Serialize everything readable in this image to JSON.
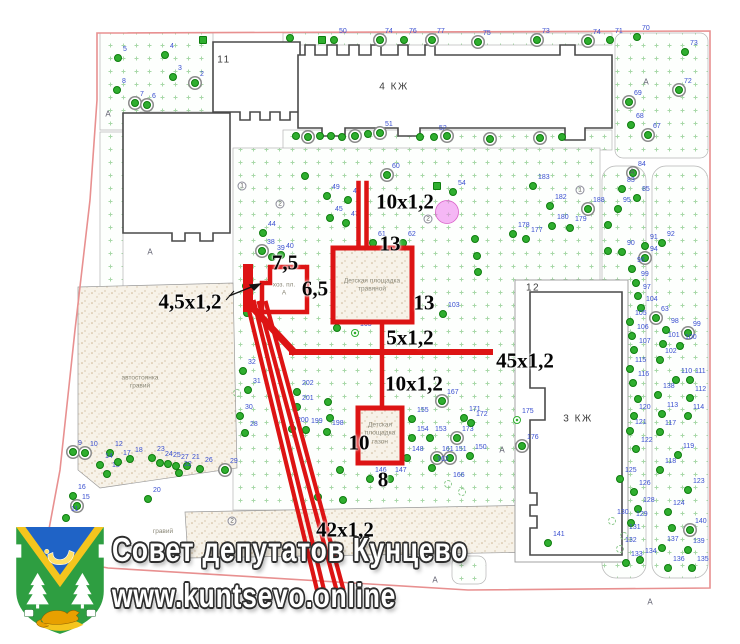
{
  "watermark": {
    "line1": "Совет депутатов Кунцево",
    "line2": "www.kuntsevo.online"
  },
  "map": {
    "building_labels": [
      {
        "text": "11",
        "x": 224,
        "y": 60
      },
      {
        "text": "4 КЖ",
        "x": 394,
        "y": 87
      },
      {
        "text": "12",
        "x": 533,
        "y": 288
      },
      {
        "text": "3 КЖ",
        "x": 578,
        "y": 419
      }
    ],
    "dimension_labels": [
      {
        "text": "10x1,2",
        "x": 405,
        "y": 202
      },
      {
        "text": "13",
        "x": 390,
        "y": 244
      },
      {
        "text": "7,5",
        "x": 285,
        "y": 263
      },
      {
        "text": "6,5",
        "x": 315,
        "y": 289
      },
      {
        "text": "4,5x1,2",
        "x": 190,
        "y": 302
      },
      {
        "text": "13",
        "x": 424,
        "y": 303
      },
      {
        "text": "5x1,2",
        "x": 410,
        "y": 338
      },
      {
        "text": "45x1,2",
        "x": 525,
        "y": 361
      },
      {
        "text": "10x1,2",
        "x": 414,
        "y": 384
      },
      {
        "text": "10",
        "x": 359,
        "y": 443
      },
      {
        "text": "8",
        "x": 383,
        "y": 480
      },
      {
        "text": "42x1,2",
        "x": 345,
        "y": 530
      }
    ],
    "area_labels": [
      {
        "lines": [
          "автостоянка",
          "гравий"
        ],
        "x": 140,
        "y": 383
      },
      {
        "lines": [
          "гравий"
        ],
        "x": 163,
        "y": 532
      },
      {
        "lines": [
          "хоз. пл.",
          "А"
        ],
        "x": 284,
        "y": 290
      },
      {
        "lines": [
          "Детская площадка",
          "травяной"
        ],
        "x": 372,
        "y": 286
      },
      {
        "lines": [
          "Детская",
          "площадка",
          "газон"
        ],
        "x": 380,
        "y": 434
      }
    ],
    "path_letter_char": "А",
    "path_letters": [
      [
        108,
        114
      ],
      [
        150,
        252
      ],
      [
        646,
        82
      ],
      [
        632,
        172
      ],
      [
        502,
        450
      ],
      [
        650,
        602
      ],
      [
        435,
        580
      ]
    ],
    "circled_marks": [
      [
        242,
        186,
        "1"
      ],
      [
        280,
        204,
        "2"
      ],
      [
        428,
        219,
        "2"
      ],
      [
        580,
        190,
        "1"
      ],
      [
        232,
        521,
        "2"
      ]
    ],
    "trees": [
      [
        118,
        58,
        "5"
      ],
      [
        165,
        55,
        "4"
      ],
      [
        173,
        77,
        "3"
      ],
      [
        195,
        83,
        "2",
        "r"
      ],
      [
        117,
        90,
        "8"
      ],
      [
        135,
        103,
        "7",
        "r"
      ],
      [
        147,
        105,
        "6",
        "r"
      ],
      [
        203,
        40,
        "",
        "s"
      ],
      [
        290,
        38,
        ""
      ],
      [
        322,
        40,
        "",
        "s"
      ],
      [
        334,
        40,
        "50"
      ],
      [
        380,
        40,
        "74",
        "r"
      ],
      [
        404,
        40,
        "76"
      ],
      [
        432,
        40,
        "77",
        "r"
      ],
      [
        478,
        42,
        "75",
        "r"
      ],
      [
        537,
        40,
        "73",
        "r"
      ],
      [
        588,
        41,
        "74",
        "r"
      ],
      [
        610,
        40,
        "71"
      ],
      [
        637,
        37,
        "70"
      ],
      [
        685,
        52,
        "73"
      ],
      [
        679,
        90,
        "72",
        "r"
      ],
      [
        629,
        102,
        "69",
        "r"
      ],
      [
        631,
        125,
        "68"
      ],
      [
        648,
        135,
        "67",
        "r"
      ],
      [
        296,
        136,
        ""
      ],
      [
        308,
        137,
        "",
        "r"
      ],
      [
        320,
        136,
        ""
      ],
      [
        331,
        136,
        ""
      ],
      [
        342,
        137,
        ""
      ],
      [
        355,
        136,
        "",
        "r"
      ],
      [
        368,
        134,
        ""
      ],
      [
        380,
        133,
        "51",
        "r"
      ],
      [
        420,
        137,
        ""
      ],
      [
        434,
        137,
        "52"
      ],
      [
        447,
        136,
        "",
        "r"
      ],
      [
        490,
        139,
        "",
        "r"
      ],
      [
        540,
        138,
        "",
        "r"
      ],
      [
        562,
        137,
        ""
      ],
      [
        305,
        176,
        ""
      ],
      [
        387,
        175,
        "60",
        "r"
      ],
      [
        437,
        186,
        "",
        "s"
      ],
      [
        453,
        192,
        "54"
      ],
      [
        327,
        196,
        "49"
      ],
      [
        348,
        200,
        "48"
      ],
      [
        330,
        218,
        "45"
      ],
      [
        346,
        223,
        "47"
      ],
      [
        263,
        233,
        "44"
      ],
      [
        262,
        251,
        "38",
        "r"
      ],
      [
        272,
        257,
        "39"
      ],
      [
        281,
        255,
        "40"
      ],
      [
        345,
        267,
        "42",
        "f"
      ],
      [
        373,
        243,
        "61"
      ],
      [
        403,
        243,
        "62"
      ],
      [
        246,
        286,
        ""
      ],
      [
        247,
        313,
        ""
      ],
      [
        475,
        239,
        ""
      ],
      [
        477,
        256,
        ""
      ],
      [
        478,
        272,
        ""
      ],
      [
        443,
        314,
        "103"
      ],
      [
        533,
        186,
        "183"
      ],
      [
        550,
        206,
        "182"
      ],
      [
        552,
        226,
        "180"
      ],
      [
        570,
        228,
        "179"
      ],
      [
        513,
        234,
        "178"
      ],
      [
        526,
        239,
        "177"
      ],
      [
        355,
        333,
        "165",
        "f"
      ],
      [
        337,
        328,
        ""
      ],
      [
        297,
        392,
        "202"
      ],
      [
        297,
        407,
        "201"
      ],
      [
        292,
        429,
        "200"
      ],
      [
        306,
        430,
        "199"
      ],
      [
        328,
        402,
        ""
      ],
      [
        330,
        418,
        ""
      ],
      [
        327,
        432,
        "198"
      ],
      [
        412,
        419,
        "155"
      ],
      [
        412,
        438,
        "154"
      ],
      [
        407,
        458,
        "148"
      ],
      [
        390,
        479,
        "147"
      ],
      [
        370,
        479,
        "146"
      ],
      [
        430,
        438,
        "153"
      ],
      [
        457,
        438,
        "173",
        "r"
      ],
      [
        442,
        401,
        "167",
        "r"
      ],
      [
        464,
        418,
        "171"
      ],
      [
        471,
        423,
        "172"
      ],
      [
        437,
        458,
        "161",
        "r"
      ],
      [
        450,
        458,
        "151",
        "r"
      ],
      [
        470,
        456,
        "150"
      ],
      [
        432,
        468,
        "162"
      ],
      [
        448,
        484,
        "166",
        "h"
      ],
      [
        462,
        492,
        "",
        "h"
      ],
      [
        340,
        470,
        ""
      ],
      [
        318,
        497,
        ""
      ],
      [
        343,
        500,
        ""
      ],
      [
        243,
        371,
        "32"
      ],
      [
        248,
        390,
        "31"
      ],
      [
        240,
        416,
        "30"
      ],
      [
        245,
        433,
        "28"
      ],
      [
        237,
        393,
        "",
        "h"
      ],
      [
        73,
        452,
        "9",
        "r"
      ],
      [
        85,
        453,
        "10",
        "r"
      ],
      [
        110,
        453,
        "12"
      ],
      [
        100,
        465,
        "14"
      ],
      [
        107,
        474,
        "13"
      ],
      [
        118,
        462,
        "17"
      ],
      [
        130,
        459,
        "18"
      ],
      [
        152,
        458,
        "23"
      ],
      [
        160,
        463,
        "24"
      ],
      [
        168,
        464,
        "25"
      ],
      [
        176,
        466,
        "27"
      ],
      [
        187,
        466,
        "21"
      ],
      [
        179,
        473,
        "22"
      ],
      [
        200,
        469,
        "26"
      ],
      [
        225,
        470,
        "29",
        "r"
      ],
      [
        148,
        499,
        "20"
      ],
      [
        73,
        496,
        "16"
      ],
      [
        77,
        506,
        "15",
        "r"
      ],
      [
        66,
        518,
        "11"
      ],
      [
        548,
        543,
        "141"
      ],
      [
        633,
        173,
        "84",
        "r"
      ],
      [
        622,
        189,
        "83"
      ],
      [
        637,
        198,
        "85"
      ],
      [
        618,
        209,
        "95"
      ],
      [
        588,
        209,
        "188",
        "r"
      ],
      [
        608,
        225,
        ""
      ],
      [
        645,
        246,
        "91"
      ],
      [
        622,
        252,
        "90"
      ],
      [
        645,
        258,
        "94",
        "r"
      ],
      [
        608,
        251,
        ""
      ],
      [
        632,
        269,
        "96"
      ],
      [
        636,
        283,
        "99"
      ],
      [
        638,
        296,
        "97"
      ],
      [
        641,
        308,
        "104"
      ],
      [
        630,
        322,
        "105"
      ],
      [
        632,
        336,
        "106"
      ],
      [
        634,
        350,
        "107"
      ],
      [
        630,
        369,
        "115"
      ],
      [
        633,
        383,
        "116"
      ],
      [
        638,
        399,
        ""
      ],
      [
        634,
        416,
        "120"
      ],
      [
        630,
        431,
        "121"
      ],
      [
        636,
        449,
        "122"
      ],
      [
        620,
        479,
        "125"
      ],
      [
        634,
        492,
        "126"
      ],
      [
        638,
        509,
        "128"
      ],
      [
        631,
        523,
        "129"
      ],
      [
        612,
        521,
        "130",
        "h"
      ],
      [
        624,
        536,
        "131",
        "h"
      ],
      [
        620,
        549,
        "132",
        "h"
      ],
      [
        640,
        560,
        "134"
      ],
      [
        626,
        563,
        "133"
      ],
      [
        662,
        243,
        "92"
      ],
      [
        656,
        318,
        "63",
        "r"
      ],
      [
        666,
        330,
        "98"
      ],
      [
        688,
        333,
        "99",
        "r"
      ],
      [
        663,
        344,
        "101"
      ],
      [
        680,
        346,
        "100"
      ],
      [
        660,
        360,
        "102"
      ],
      [
        676,
        380,
        "110"
      ],
      [
        690,
        380,
        "111"
      ],
      [
        658,
        395,
        "138"
      ],
      [
        690,
        398,
        "112"
      ],
      [
        662,
        414,
        "113"
      ],
      [
        688,
        416,
        "114"
      ],
      [
        660,
        432,
        "117"
      ],
      [
        678,
        455,
        "119"
      ],
      [
        660,
        470,
        "118"
      ],
      [
        688,
        490,
        "123"
      ],
      [
        668,
        512,
        "124"
      ],
      [
        672,
        528,
        ""
      ],
      [
        690,
        530,
        "140",
        "r"
      ],
      [
        662,
        548,
        "137"
      ],
      [
        688,
        550,
        "139"
      ],
      [
        668,
        568,
        "136"
      ],
      [
        692,
        568,
        "135"
      ],
      [
        517,
        420,
        "175",
        "f"
      ],
      [
        522,
        446,
        "176",
        "r"
      ]
    ],
    "colors": {
      "annotation_red": "#dd1414",
      "tree_green": "#2fae2f",
      "tree_number_blue": "#3a4fd0",
      "boundary_pink": "#e89090",
      "lawn_dot_green": "#a8d8a8",
      "stipple_tan": "#cbb493",
      "magenta_circle": "#ee7bee"
    }
  }
}
